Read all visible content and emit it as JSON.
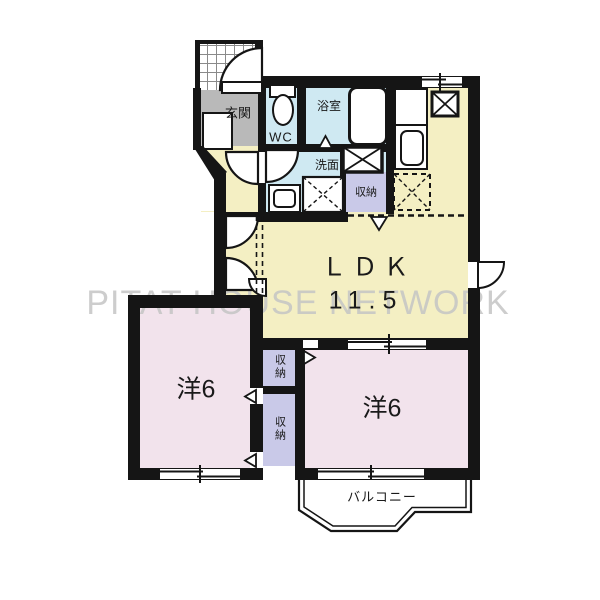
{
  "watermark": "PITAT HOUSE NETWORK",
  "rooms": {
    "genkan": {
      "label": "玄関"
    },
    "wc": {
      "label": "WC"
    },
    "bath": {
      "label": "浴室"
    },
    "washroom": {
      "label": "洗面"
    },
    "storage_wash": {
      "label": "収納"
    },
    "ldk": {
      "label": "ＬＤＫ",
      "size": "11.5"
    },
    "west_left": {
      "label": "洋6"
    },
    "west_right": {
      "label": "洋6"
    },
    "storage_mid_top": {
      "label": "収納"
    },
    "storage_mid_bottom": {
      "label": "収納"
    },
    "balcony": {
      "label": "バルコニー"
    }
  },
  "colors": {
    "wall": "#151515",
    "floor_ldk_yellow": "#f4efc3",
    "floor_room_pink": "#f2e3ec",
    "floor_wet_blue": "#cfe9f2",
    "floor_storage_purple": "#c9c9e8",
    "floor_genkan_gray": "#b9b9b9",
    "balcony_white": "#ffffff",
    "watermark_gray": "#c5c5c5"
  }
}
